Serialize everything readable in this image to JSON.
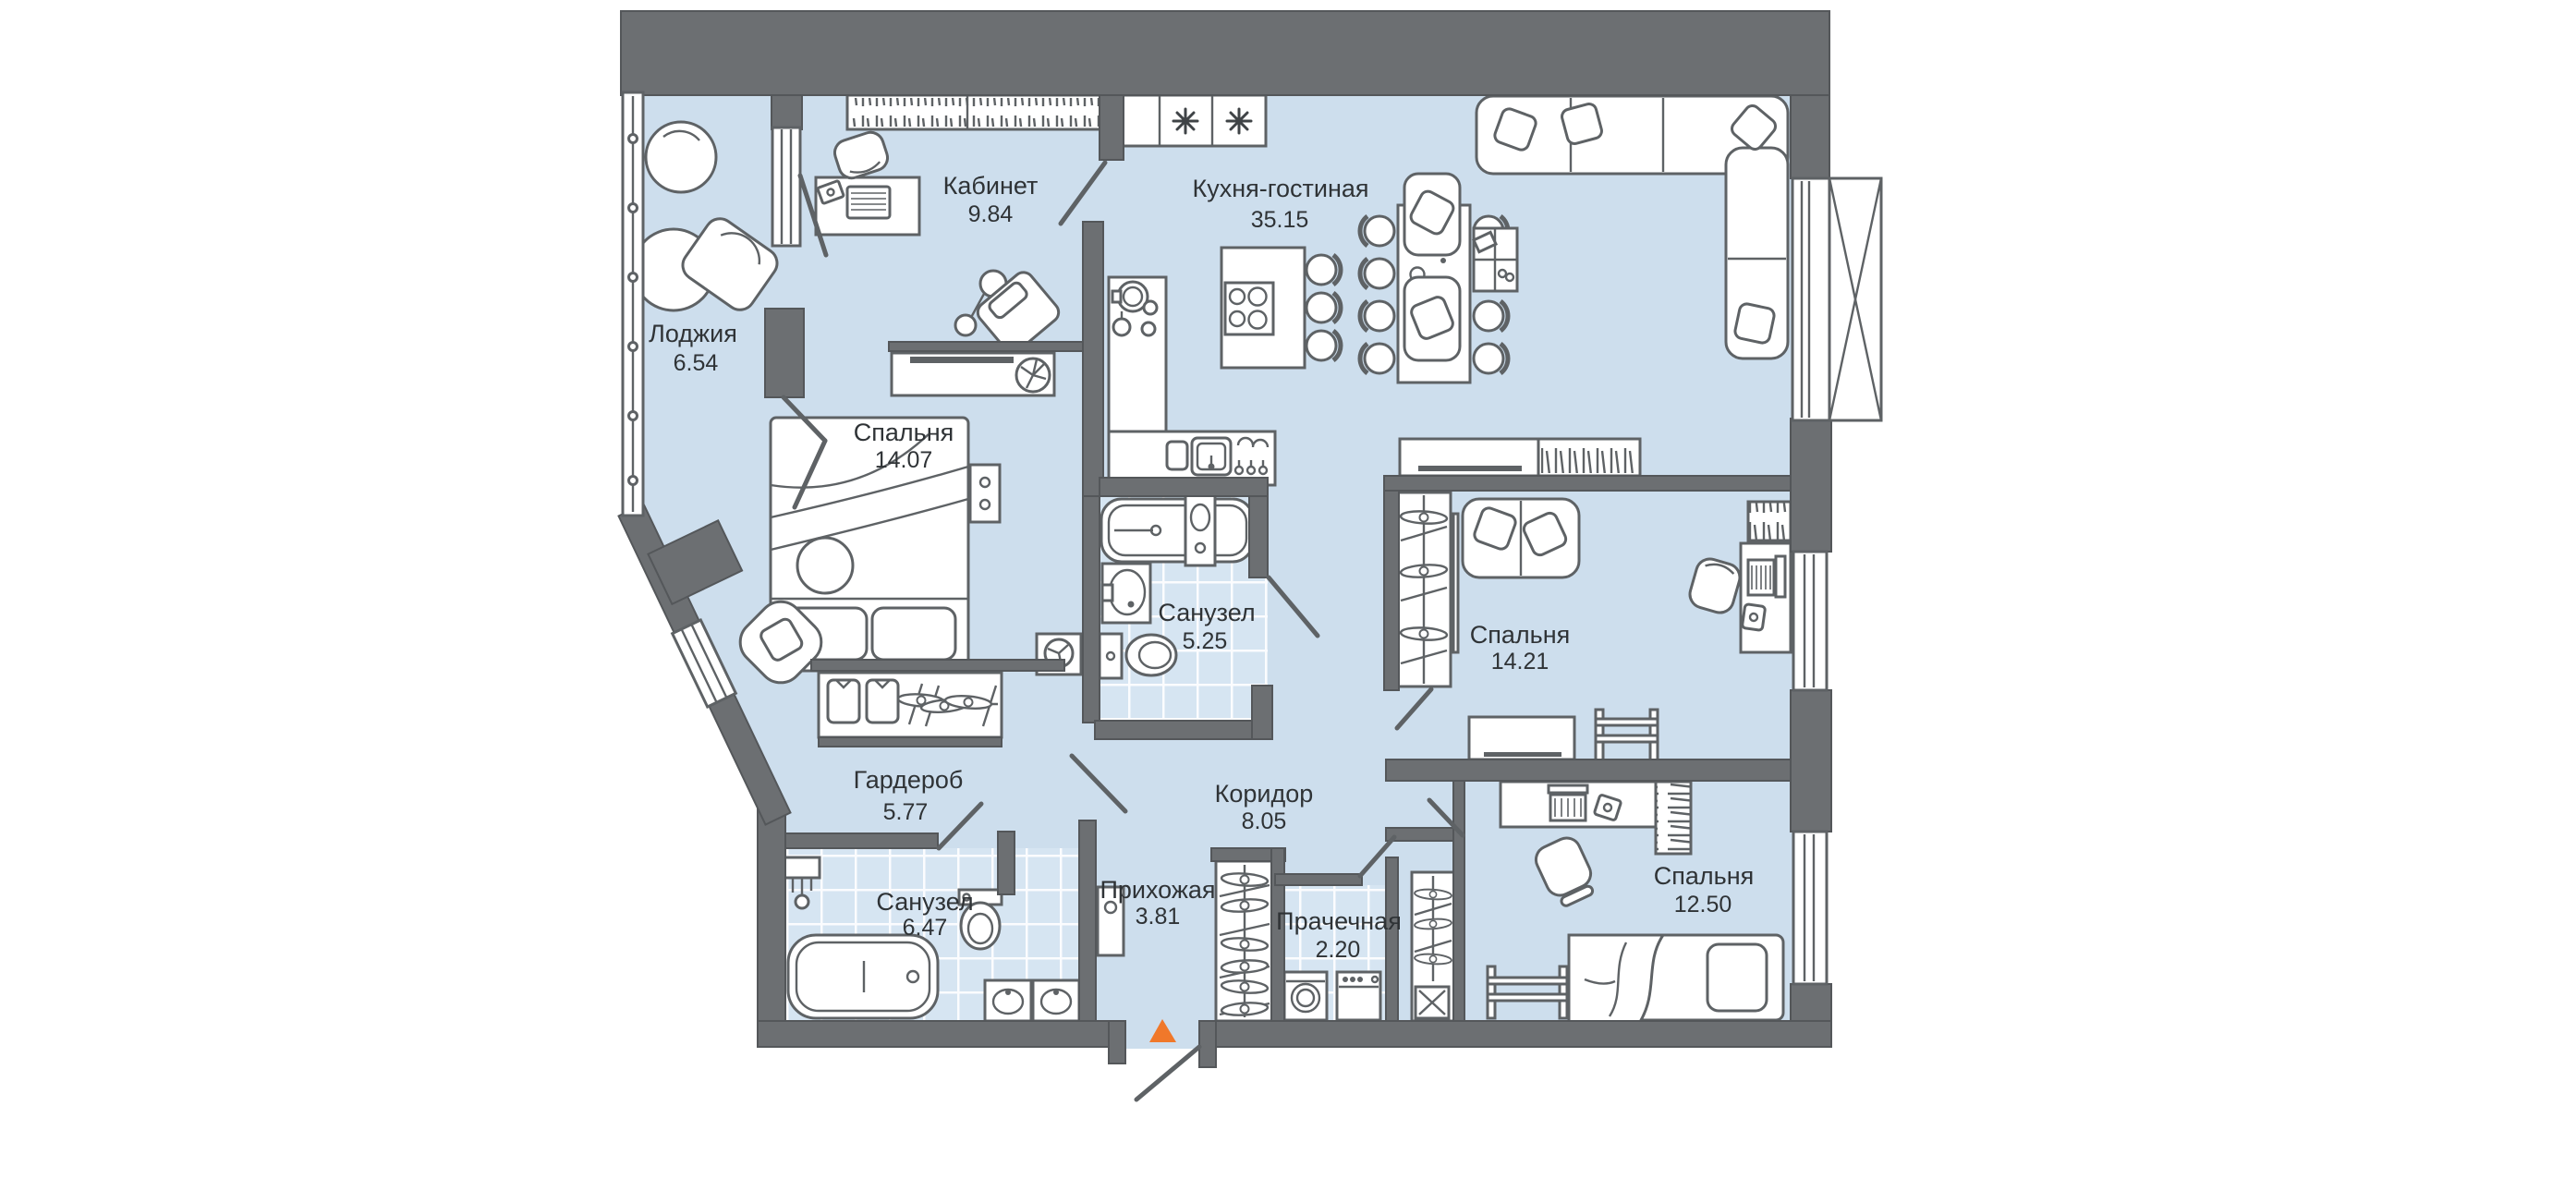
{
  "plan": {
    "rooms": {
      "loggia": {
        "label": "Лоджия",
        "area": "6.54"
      },
      "office": {
        "label": "Кабинет",
        "area": "9.84"
      },
      "kitchen_living": {
        "label": "Кухня-гостиная",
        "area": "35.15"
      },
      "bedroom_master": {
        "label": "Спальня",
        "area": "14.07"
      },
      "bathroom_small": {
        "label": "Санузел",
        "area": "5.25"
      },
      "bedroom_middle": {
        "label": "Спальня",
        "area": "14.21"
      },
      "wardrobe_room": {
        "label": "Гардероб",
        "area": "5.77"
      },
      "corridor": {
        "label": "Коридор",
        "area": "8.05"
      },
      "bathroom_main": {
        "label": "Санузел",
        "area": "6.47"
      },
      "hallway": {
        "label": "Прихожая",
        "area": "3.81"
      },
      "laundry": {
        "label": "Прачечная",
        "area": "2.20"
      },
      "bedroom_child": {
        "label": "Спальня",
        "area": "12.50"
      }
    },
    "colors": {
      "floor": "#cddeed",
      "tile": "#d6e5f2",
      "wall": "#6c6f72",
      "outline": "#5e6265",
      "label": "#2f3336",
      "entry_marker": "#f0782a",
      "background": "#ffffff"
    }
  }
}
